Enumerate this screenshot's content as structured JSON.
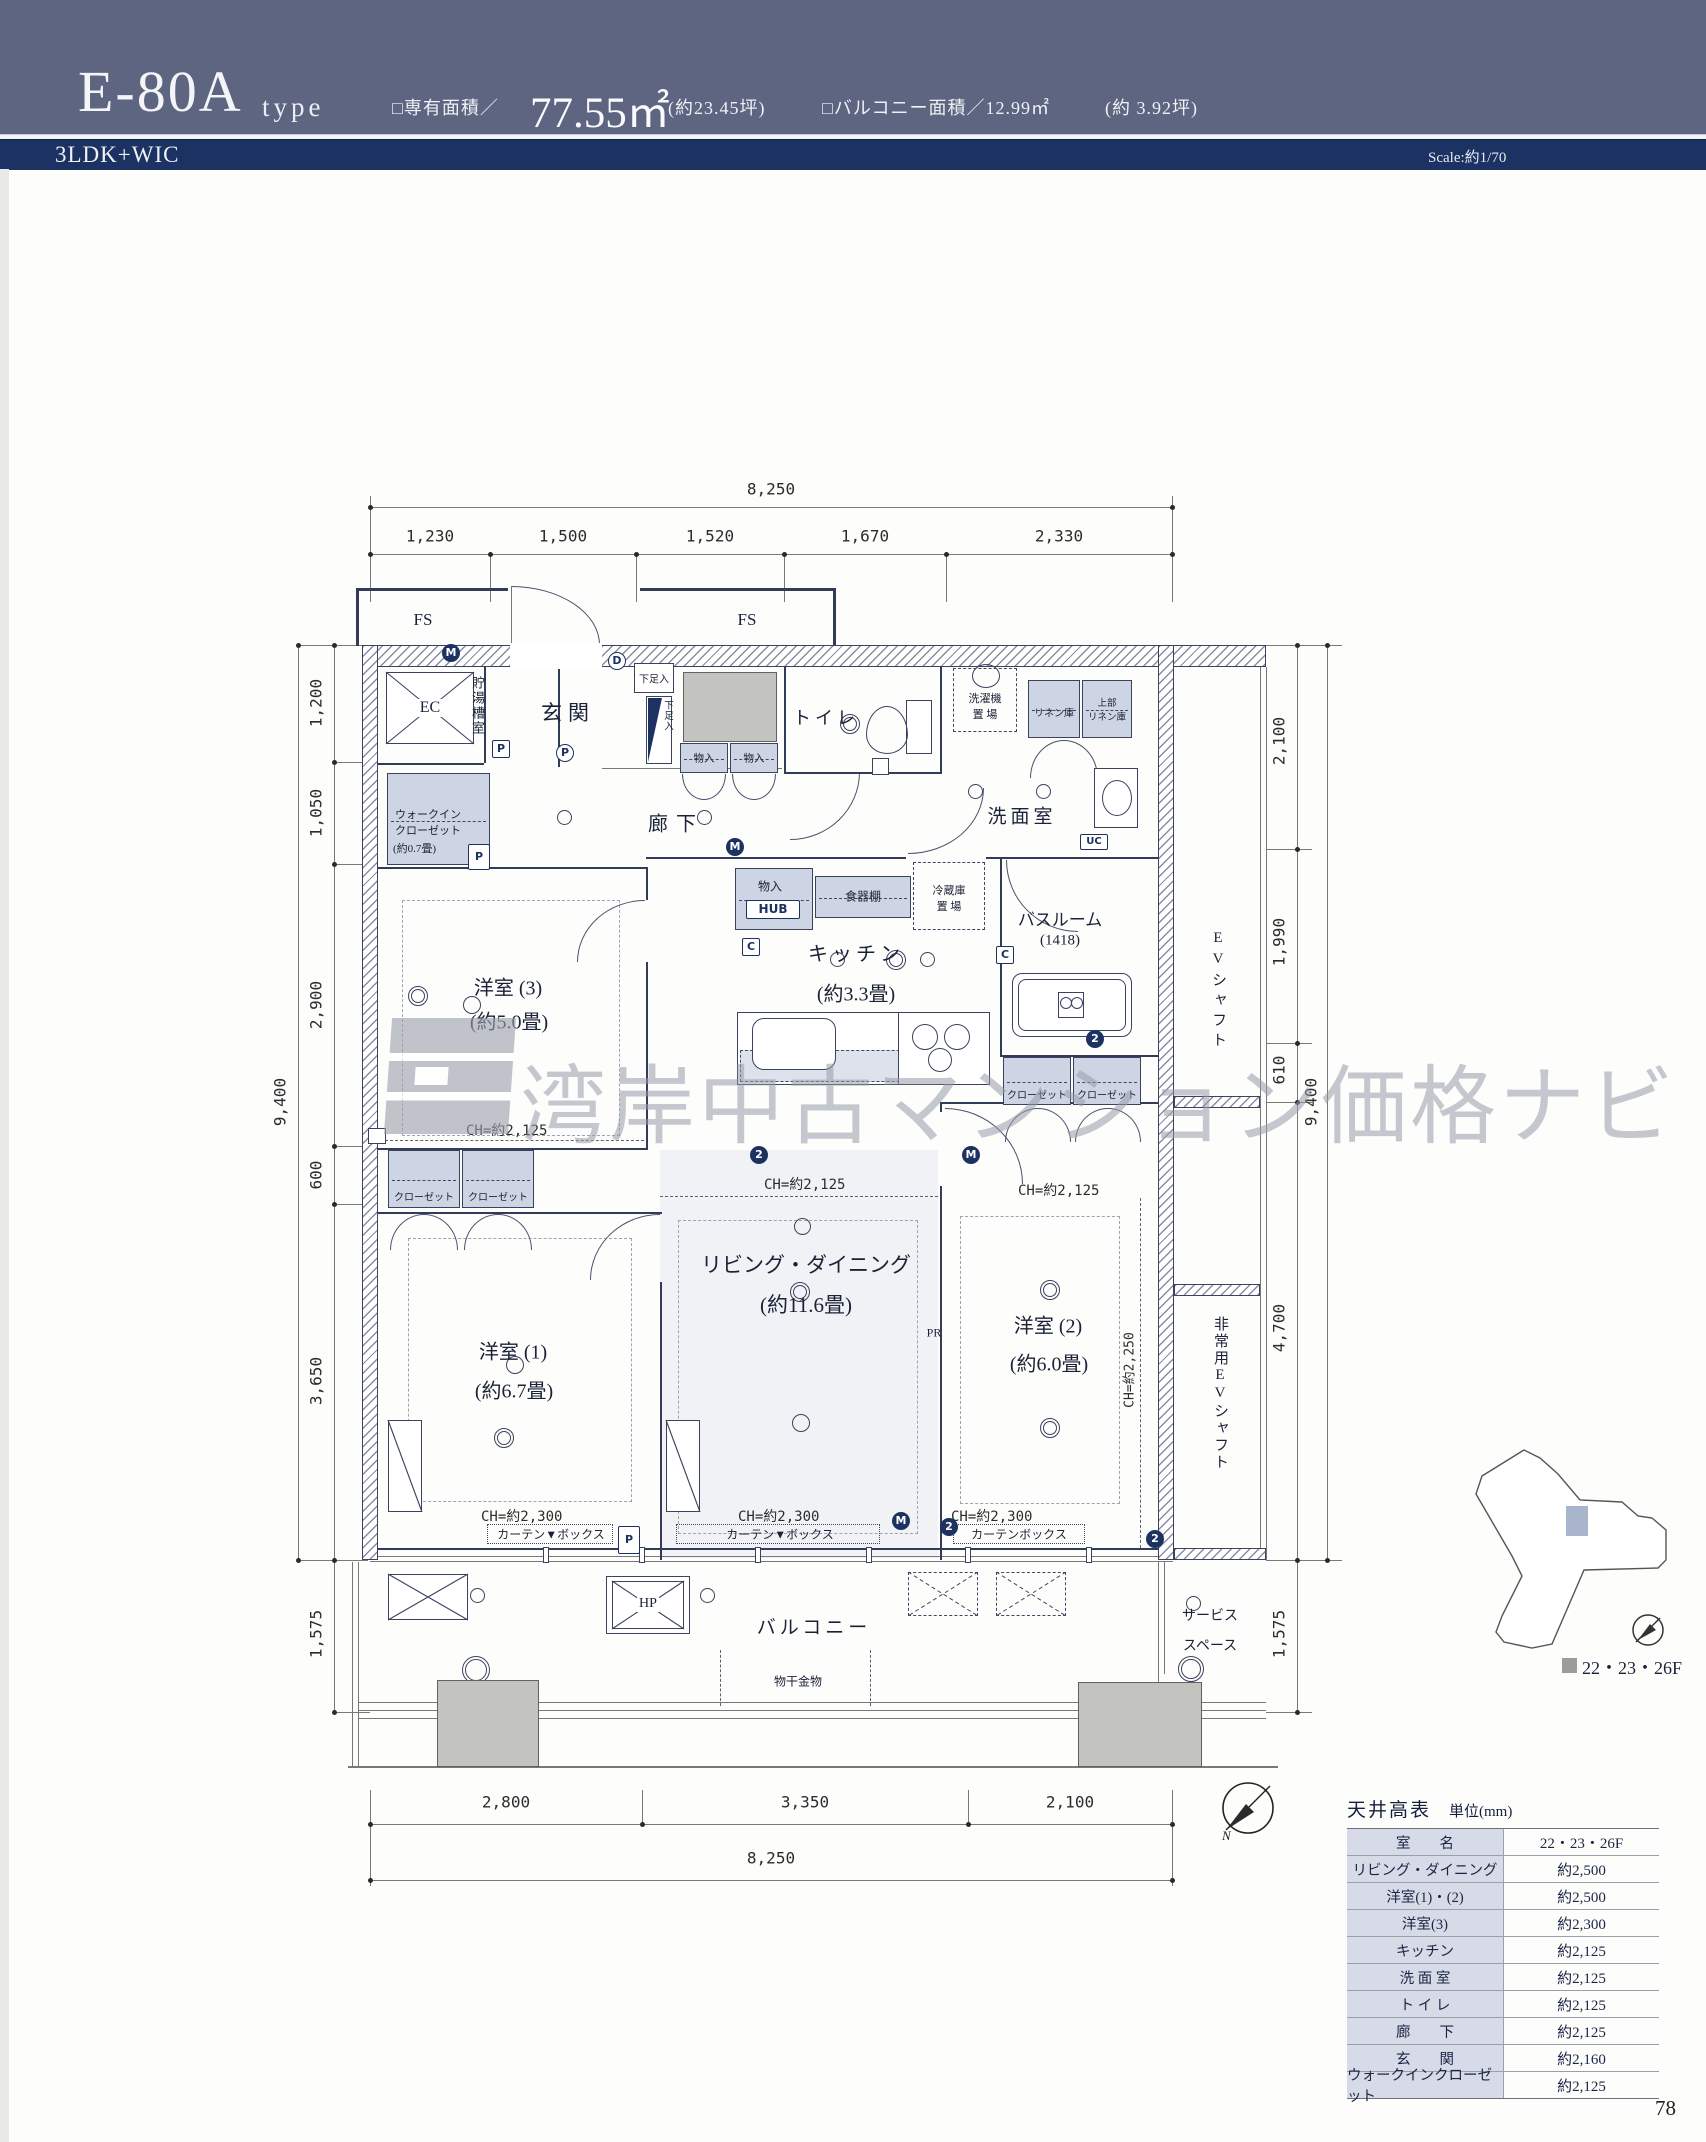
{
  "header": {
    "model": "E-80A",
    "model_suffix": "type",
    "area_label": "□専有面積／",
    "area_value": "77.55㎡",
    "area_tsubo": "(約23.45坪)",
    "balcony_area": "□バルコニー面積／12.99㎡",
    "balcony_tsubo": "(約  3.92坪)",
    "plan_type": "3LDK+WIC",
    "scale": "Scale:約1/70"
  },
  "dims": {
    "top_total": "8,250",
    "top_segs": [
      "1,230",
      "1,500",
      "1,520",
      "1,670",
      "2,330"
    ],
    "bottom_total": "8,250",
    "bottom_segs": [
      "2,800",
      "3,350",
      "2,100"
    ],
    "left_total": "9,400",
    "left_segs": [
      "1,200",
      "1,050",
      "2,900",
      "600",
      "3,650"
    ],
    "left_balcony": "1,575",
    "right_top": "2,100",
    "right_total": "9,400",
    "right_segs": [
      "1,990",
      "610",
      "4,700"
    ],
    "right_balcony": "1,575"
  },
  "rooms": {
    "genkan": "玄関",
    "rouka": "廊下",
    "toilet": "トイレ",
    "senmen": "洗面室",
    "bath": "バスルーム",
    "bath_size": "(1418)",
    "kitchen": "キッチン",
    "kitchen_size": "(約3.3畳)",
    "ld": "リビング・ダイニング",
    "ld_size": "(約11.6畳)",
    "yoshitsu1": "洋室 (1)",
    "yoshitsu1_size": "(約6.7畳)",
    "yoshitsu2": "洋室 (2)",
    "yoshitsu2_size": "(約6.0畳)",
    "yoshitsu3": "洋室 (3)",
    "yoshitsu3_size": "(約5.0畳)",
    "balcony": "バルコニー",
    "wic_line1": "ウォークイン",
    "wic_line2": "クローゼット",
    "wic_size": "(約0.7畳)",
    "choto": "貯湯槽室",
    "ec": "EC",
    "service1": "サービス",
    "service2": "スペース",
    "ev": "EVシャフト",
    "ev_emergency": "非常用EVシャフト"
  },
  "fixtures": {
    "fs": "FS",
    "shoe": "下足入",
    "mono": "物入",
    "hub": "HUB",
    "laundry1": "洗濯機",
    "laundry2": "置 場",
    "linen": "リネン庫",
    "linen_up1": "上部",
    "linen_up2": "リネン庫",
    "cupboard": "食器棚",
    "fridge1": "冷蔵庫",
    "fridge2": "置 場",
    "closet": "クローゼット",
    "curtain_v": "カーテン▼ボックス",
    "curtain": "カーテンボックス",
    "monohoshi": "物干金物",
    "hp": "HP",
    "pr": "PR",
    "uc": "UC"
  },
  "ch": {
    "c2125": "CH=約2,125",
    "c2250": "CH=約2,250",
    "c2300": "CH=約2,300"
  },
  "symbols": {
    "m": "M",
    "p": "P",
    "c": "C",
    "d": "D",
    "n": "N",
    "two": "2"
  },
  "table": {
    "title": "天井高表",
    "unit": "単位(mm)",
    "rows": [
      {
        "name": "室　　名",
        "value": "22・23・26F"
      },
      {
        "name": "リビング・ダイニング",
        "value": "約2,500"
      },
      {
        "name": "洋室(1)・(2)",
        "value": "約2,500"
      },
      {
        "name": "洋室(3)",
        "value": "約2,300"
      },
      {
        "name": "キッチン",
        "value": "約2,125"
      },
      {
        "name": "洗 面 室",
        "value": "約2,125"
      },
      {
        "name": "ト イ レ",
        "value": "約2,125"
      },
      {
        "name": "廊　　下",
        "value": "約2,125"
      },
      {
        "name": "玄　　関",
        "value": "約2,160"
      },
      {
        "name": "ウォークインクローゼット",
        "value": "約2,125"
      }
    ]
  },
  "keyplan": {
    "legend": "22・23・26F"
  },
  "watermark": {
    "text": "湾岸中古マンション価格ナビ"
  },
  "page": {
    "number": "78"
  }
}
